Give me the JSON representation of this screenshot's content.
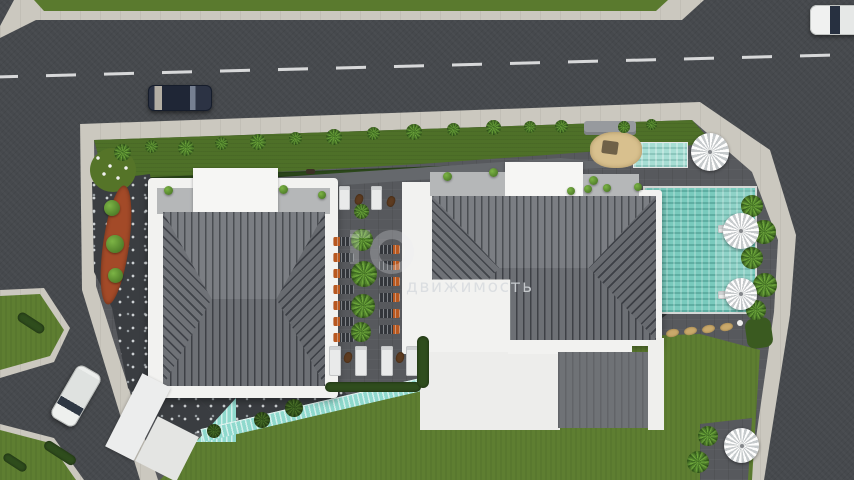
{
  "scene": {
    "title": "Aerial 3D render of a residential complex site plan",
    "watermark": {
      "text": "движимость",
      "logo": "faint ring and letter watermark"
    }
  },
  "palette": {
    "asphalt": "#46494d",
    "sidewalk": "#cbc8bf",
    "grassMedian": "#5a7a2e",
    "lawn": "#5e7e31",
    "garden": "#4e7028",
    "hedge": "#2f4d1d",
    "palmL": "#6ea83c",
    "palmD": "#3e6b22",
    "deck": "#57595d",
    "gravel": "#3a3d41",
    "white": "#f2f2f0",
    "terrace": "#b5b7b8",
    "roofBase": "#75787d",
    "roofLine": "#43464b",
    "pool": "#79cabd",
    "poolLight": "#a7ded4",
    "cascade": "#8fd9cd",
    "terracotta": "#a34a28",
    "lounger": "#b9581f",
    "sand": "#d8c08e",
    "carDark": "#232a3a",
    "carWhite": "#eef0ee",
    "drive": "#65686c"
  },
  "objects": {
    "roads": [
      "top-horizontal-road",
      "right-diagonal-road",
      "bottom-left-diagonal-road"
    ],
    "buildings": [
      {
        "id": "left-building",
        "roof": "dark gray hip roof with white parapet"
      },
      {
        "id": "right-building",
        "roof": "dark gray hip roof with white flat wing"
      }
    ],
    "pools": [
      {
        "id": "main-pool",
        "color": "teal"
      },
      {
        "id": "kids-pool",
        "color": "light teal"
      }
    ],
    "parasols_count": 4,
    "cars": [
      {
        "id": "dark-sedan",
        "location": "top road"
      },
      {
        "id": "white-van",
        "location": "bottom-left road"
      },
      {
        "id": "white-car-partial",
        "location": "top-right corner"
      }
    ],
    "courtyard": {
      "orange_loungers": 13,
      "white_loungers": 6,
      "palm_row": 5
    },
    "water_feature": "teal cascade along lawn edge",
    "playground": "sand pit with gray bench"
  }
}
